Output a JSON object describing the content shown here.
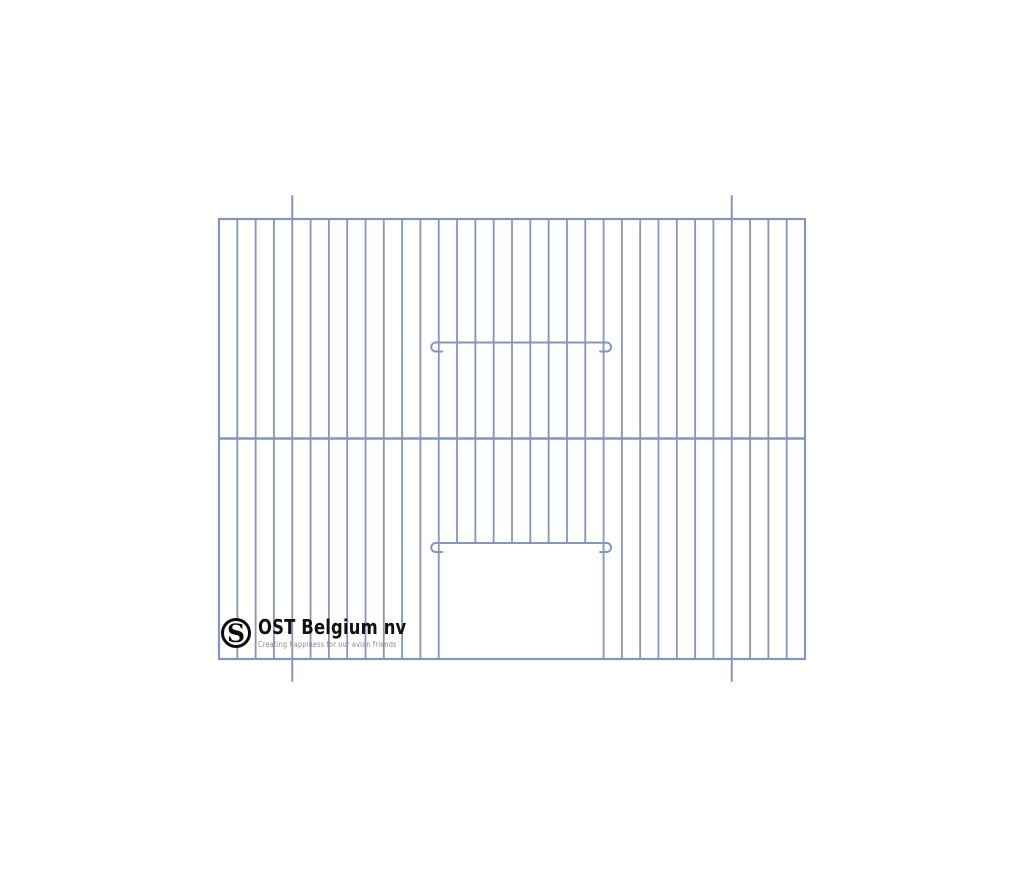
{
  "page": {
    "background": "#ffffff",
    "width": 1024,
    "height": 878
  },
  "logo": {
    "monogram": "S",
    "brand": "OST Belgium nv",
    "tagline": "Creating happiness for our avian friends",
    "brand_color": "#111111",
    "tagline_color": "#8b8b8b",
    "ring_color": "#0d0d0d"
  },
  "drawing": {
    "description": "Technical line drawing of a wire cage front panel with sliding-door opening, wire guide bar and mounting pins",
    "wire_color": "#8496bc",
    "stroke": {
      "wire": 1.8,
      "frame": 2.2,
      "middle": 2.5,
      "bar": 2,
      "pin": 2
    },
    "frame": {
      "left": 219,
      "top": 219,
      "right": 805,
      "bottom": 659
    },
    "vertical_wires": {
      "gaps": 32,
      "internal_count": 31
    },
    "middle_wire_y": 438.5,
    "guide_bar_y": 342.5,
    "door": {
      "left_wire_index": 12,
      "right_wire_index": 21,
      "bar_y": 543
    },
    "mounting_pins": {
      "wire_indices": [
        4,
        28
      ],
      "top_y": 196,
      "bottom_y": 681
    }
  }
}
